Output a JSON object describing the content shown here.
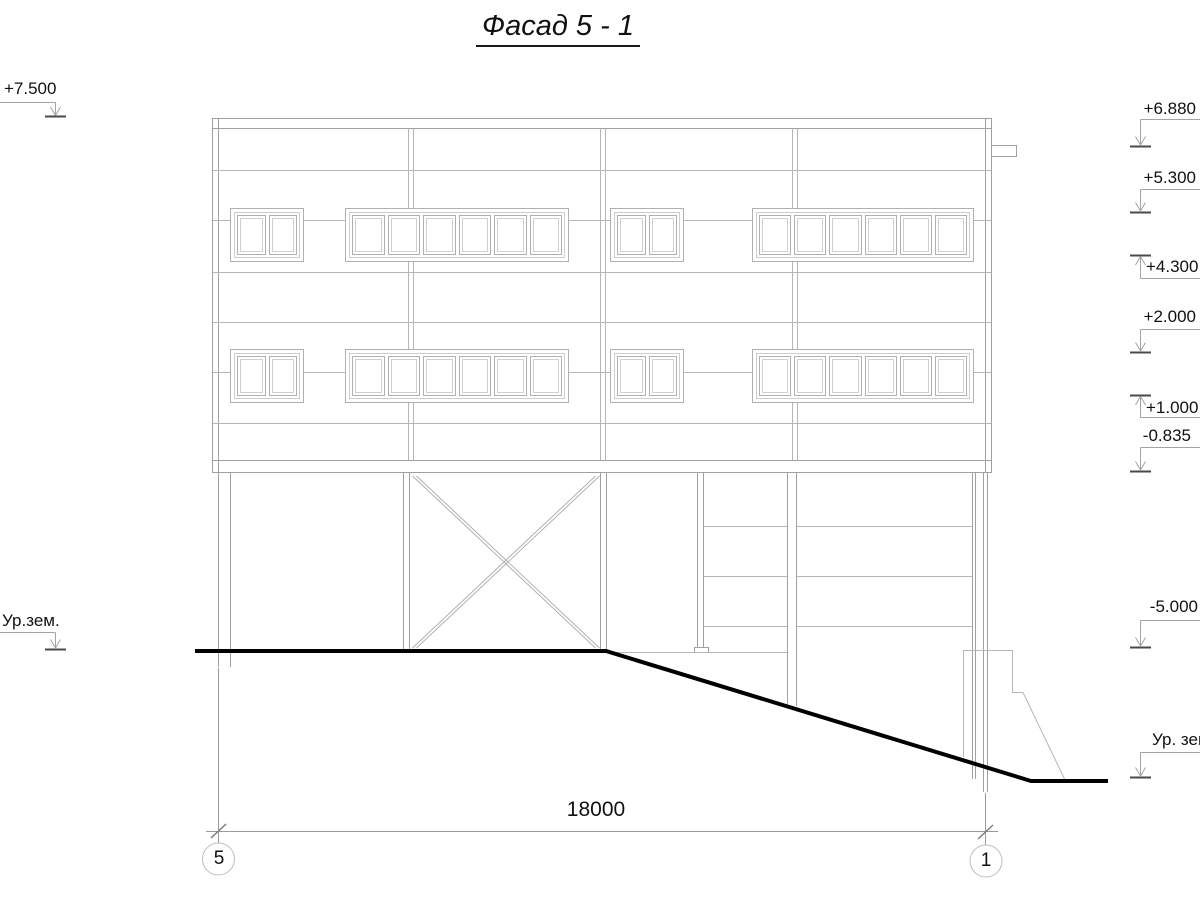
{
  "title": "Фасад 5 - 1",
  "dimension": "18000",
  "axis_bubbles": [
    "5",
    "1"
  ],
  "elevations_left": [
    {
      "label": "+7.500"
    },
    {
      "label": "Ур.зем."
    }
  ],
  "elevations_right": [
    {
      "label": "+6.880"
    },
    {
      "label": "+5.300"
    },
    {
      "label": "+4.300"
    },
    {
      "label": "+2.000"
    },
    {
      "label": "+1.000"
    },
    {
      "label": "-0.835"
    },
    {
      "label": "-5.000"
    },
    {
      "label": "Ур. зем."
    }
  ],
  "facade": {
    "window_rows": 2,
    "window_groups_per_row": 4,
    "pane_counts": [
      2,
      6,
      2,
      6
    ]
  },
  "colors": {
    "line": "#a0a0a0",
    "light_line": "#b6b6b6",
    "window_frame": "#b0b0b0",
    "tick": "#4a4a4a",
    "ground": "#000000",
    "text": "#111111"
  }
}
